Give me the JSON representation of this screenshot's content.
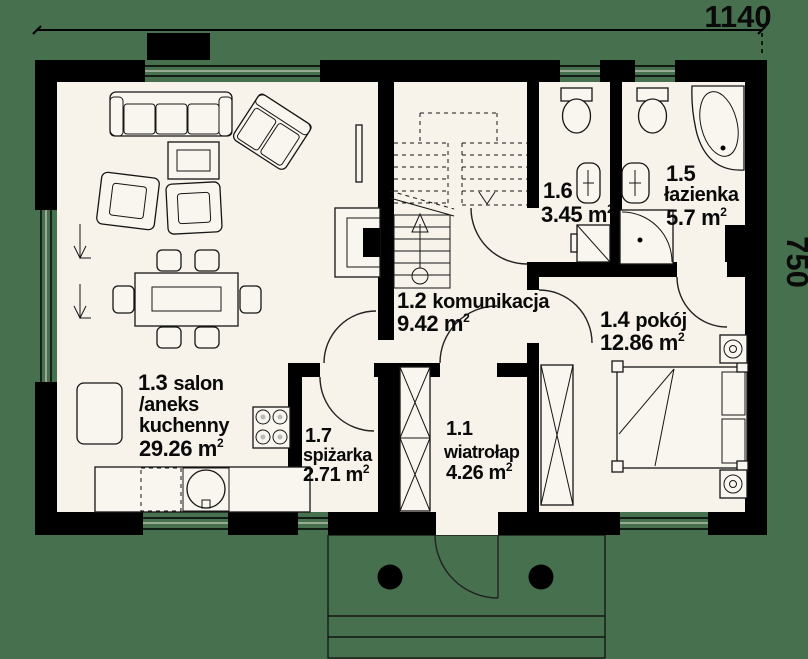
{
  "dimensions": {
    "width_label": "1140",
    "height_label": "750"
  },
  "sup": "2",
  "rooms": {
    "wiatrolap": {
      "num": "1.1",
      "name": "wiatrołap",
      "area": "4.26 m"
    },
    "komunikacja": {
      "num": "1.2",
      "name": "komunikacja",
      "area": "9.42 m"
    },
    "salon": {
      "num": "1.3",
      "name": "salon",
      "name2": "/aneks",
      "name3": "kuchenny",
      "area": "29.26 m"
    },
    "pokoj": {
      "num": "1.4",
      "name": "pokój",
      "area": "12.86 m"
    },
    "lazienka": {
      "num": "1.5",
      "name": "łazienka",
      "area": "5.7 m"
    },
    "wc": {
      "num": "1.6",
      "area": "3.45 m"
    },
    "spizarka": {
      "num": "1.7",
      "name": "spiżarka",
      "area": "2.71 m"
    }
  },
  "colors": {
    "background": "#47704e",
    "wall": "#000000",
    "floor": "#f7f2ea"
  }
}
